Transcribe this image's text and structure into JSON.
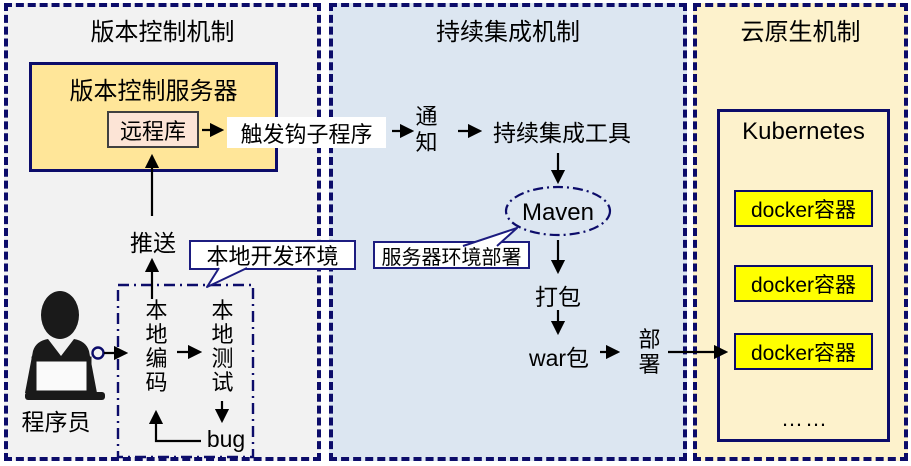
{
  "colors": {
    "navy_border": "#0c0c6a",
    "callout_border": "#1c1c80",
    "vc_panel_bg": "#f2f2f2",
    "ci_panel_bg": "#dce6f1",
    "cloud_panel_bg": "#fdf2cc",
    "server_box_bg": "#ffe699",
    "remote_repo_bg": "#fce4d6",
    "docker_box_bg": "#ffff00",
    "arrow_color": "#000000"
  },
  "panels": {
    "version_control": {
      "title": "版本控制机制"
    },
    "continuous_integration": {
      "title": "持续集成机制"
    },
    "cloud_native": {
      "title": "云原生机制"
    }
  },
  "version_control": {
    "server_title": "版本控制服务器",
    "remote_repo": "远程库",
    "push_label": "推送",
    "programmer_label": "程序员",
    "local_env_callout": "本地开发环境",
    "local_coding": "本地编码",
    "local_testing": "本地测试",
    "bug_label": "bug"
  },
  "ci": {
    "trigger_hook": "触发钩子程序",
    "notify": "通知",
    "ci_tool": "持续集成工具",
    "maven": "Maven",
    "server_env_callout": "服务器环境部署",
    "package_label": "打包",
    "war_label": "war包",
    "deploy_label": "部署"
  },
  "cloud_native": {
    "kubernetes_title": "Kubernetes",
    "containers": [
      "docker容器",
      "docker容器",
      "docker容器"
    ],
    "more": "……"
  }
}
